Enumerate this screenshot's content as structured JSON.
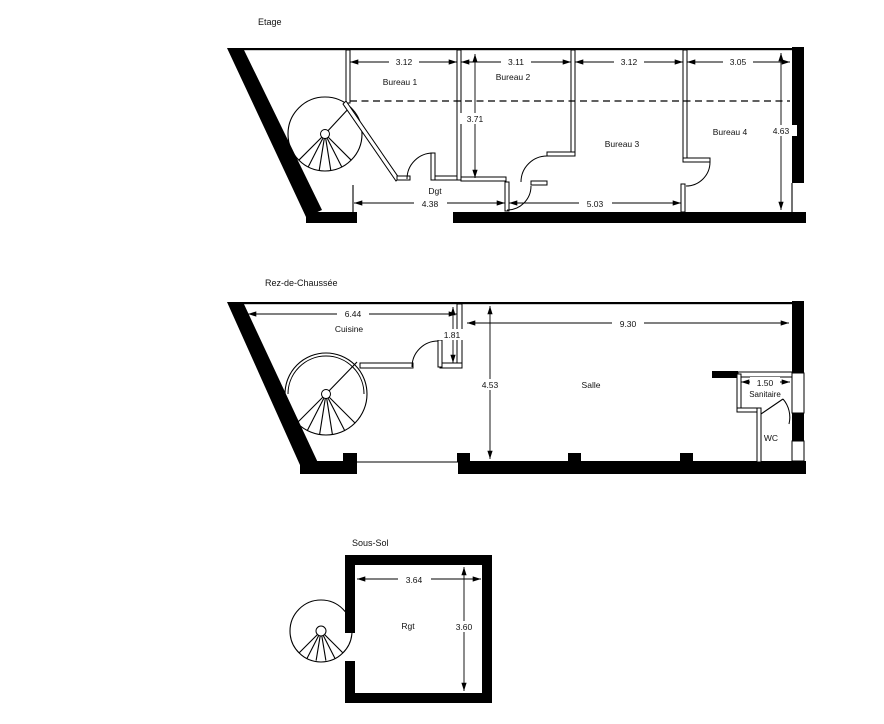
{
  "page": {
    "background": "#ffffff",
    "line_color": "#000000"
  },
  "floors": {
    "etage": {
      "title": "Etage",
      "rooms": {
        "bureau1": "Bureau 1",
        "bureau2": "Bureau 2",
        "bureau3": "Bureau 3",
        "bureau4": "Bureau 4",
        "corridor": "Dgt"
      },
      "dims": {
        "bureau1_width": "3.12",
        "bureau2_width": "3.11",
        "bureau3_width": "3.12",
        "bureau4_width": "3.05",
        "depth_left": "3.71",
        "depth_right": "4.63",
        "corridor_length": "4.38",
        "bottom_right_length": "5.03"
      }
    },
    "rdc": {
      "title": "Rez-de-Chaussée",
      "rooms": {
        "cuisine": "Cuisine",
        "salle": "Salle",
        "sanitaire": "Sanitaire",
        "wc": "WC"
      },
      "dims": {
        "cuisine_width": "6.44",
        "recess_depth": "1.81",
        "salle_width": "9.30",
        "depth": "4.53",
        "sanitaire_width": "1.50"
      }
    },
    "soussol": {
      "title": "Sous-Sol",
      "rooms": {
        "rgt": "Rgt"
      },
      "dims": {
        "width": "3.64",
        "depth": "3.60"
      }
    }
  }
}
